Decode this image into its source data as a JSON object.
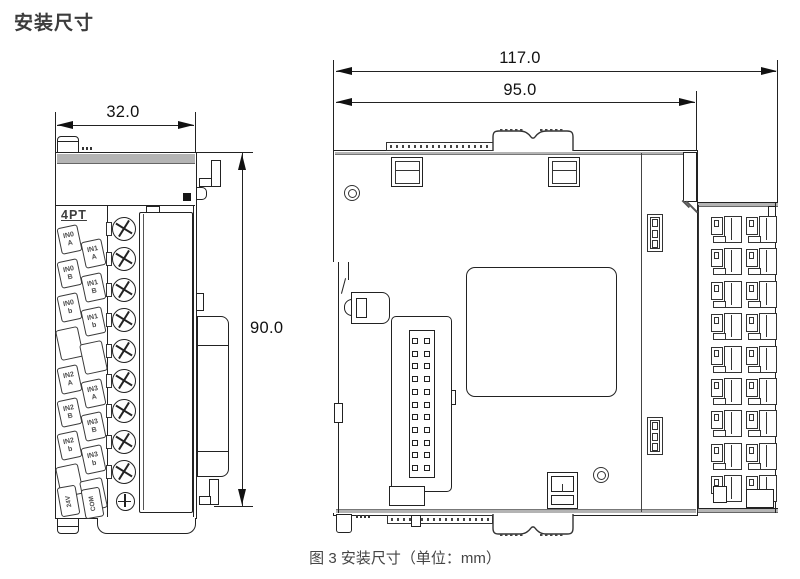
{
  "page": {
    "title": "安装尺寸",
    "caption": "图 3 安装尺寸（单位：mm）"
  },
  "colors": {
    "line": "#222222",
    "band": "#b4b4b4",
    "dim_text": "#111111",
    "text": "#3c3c3c"
  },
  "front_view": {
    "dim_width": "32.0",
    "dim_height": "90.0",
    "module_label": "4PT",
    "labels_col_a": [
      {
        "top": "IN0",
        "bottom": "A"
      },
      {
        "top": "IN0",
        "bottom": "B"
      },
      {
        "top": "IN0",
        "bottom": "b"
      },
      {
        "top": "",
        "bottom": ""
      },
      {
        "top": "IN2",
        "bottom": "A"
      },
      {
        "top": "IN2",
        "bottom": "B"
      },
      {
        "top": "IN2",
        "bottom": "b"
      },
      {
        "top": "",
        "bottom": ""
      }
    ],
    "labels_col_b": [
      {
        "top": "IN1",
        "bottom": "A"
      },
      {
        "top": "IN1",
        "bottom": "B"
      },
      {
        "top": "IN1",
        "bottom": "b"
      },
      {
        "top": "",
        "bottom": ""
      },
      {
        "top": "IN3",
        "bottom": "A"
      },
      {
        "top": "IN3",
        "bottom": "B"
      },
      {
        "top": "IN3",
        "bottom": "b"
      },
      {
        "top": "",
        "bottom": ""
      }
    ],
    "label_bottom_a": "24V",
    "label_bottom_b": "COM",
    "screw_count": 9
  },
  "side_view": {
    "dim_total_width": "117.0",
    "dim_body_width": "95.0",
    "pin_rows": 11,
    "pin_cols": 2,
    "clamp_rows": 9,
    "clamp_cols": 2
  }
}
